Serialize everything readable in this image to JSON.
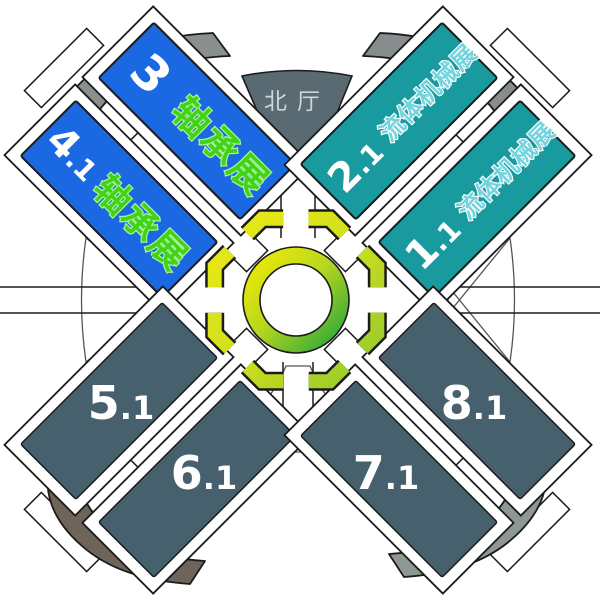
{
  "map": {
    "north_hall": {
      "label": "北厅"
    },
    "halls": [
      {
        "id": "hall-3",
        "num": "3",
        "suffix": "",
        "exhibition": "轴承展",
        "color": "#1a68e2"
      },
      {
        "id": "hall-4.1",
        "num": "4",
        "suffix": ".1",
        "exhibition": "轴承展",
        "color": "#1a68e2"
      },
      {
        "id": "hall-2.1",
        "num": "2",
        "suffix": ".1",
        "exhibition": "流体机械展",
        "color": "#189a9e"
      },
      {
        "id": "hall-1.1",
        "num": "1",
        "suffix": ".1",
        "exhibition": "流体机械展",
        "color": "#189a9e"
      },
      {
        "id": "hall-5.1",
        "num": "5",
        "suffix": ".1",
        "exhibition": "",
        "color": "#46606e"
      },
      {
        "id": "hall-6.1",
        "num": "6",
        "suffix": ".1",
        "exhibition": "",
        "color": "#46606e"
      },
      {
        "id": "hall-7.1",
        "num": "7",
        "suffix": ".1",
        "exhibition": "",
        "color": "#46606e"
      },
      {
        "id": "hall-8.1",
        "num": "8",
        "suffix": ".1",
        "exhibition": "",
        "color": "#46606e"
      }
    ],
    "colors": {
      "blue_hall": "#1a68e2",
      "teal_hall": "#189a9e",
      "dark_hall": "#46606e",
      "north_hall": "#5a6a73",
      "north_hall_text": "#ccd5d8",
      "bearing_text_green": "#40d318",
      "fluid_text_cyan": "#74d4de",
      "ring_yellow": "#f2ea06",
      "ring_mid": "#b8d71e",
      "ring_green": "#1aa23e",
      "walk_yellow": "#eeea12",
      "walk_mid": "#cfdf1f",
      "walk_green": "#8cc72e",
      "corner_gray_nw": "#8a8f90",
      "corner_gray_ne": "#878d8e",
      "corner_taupe_sw": "#6e6459",
      "corner_green_se": "#8e9893",
      "outline": "#1b1b1b"
    }
  }
}
